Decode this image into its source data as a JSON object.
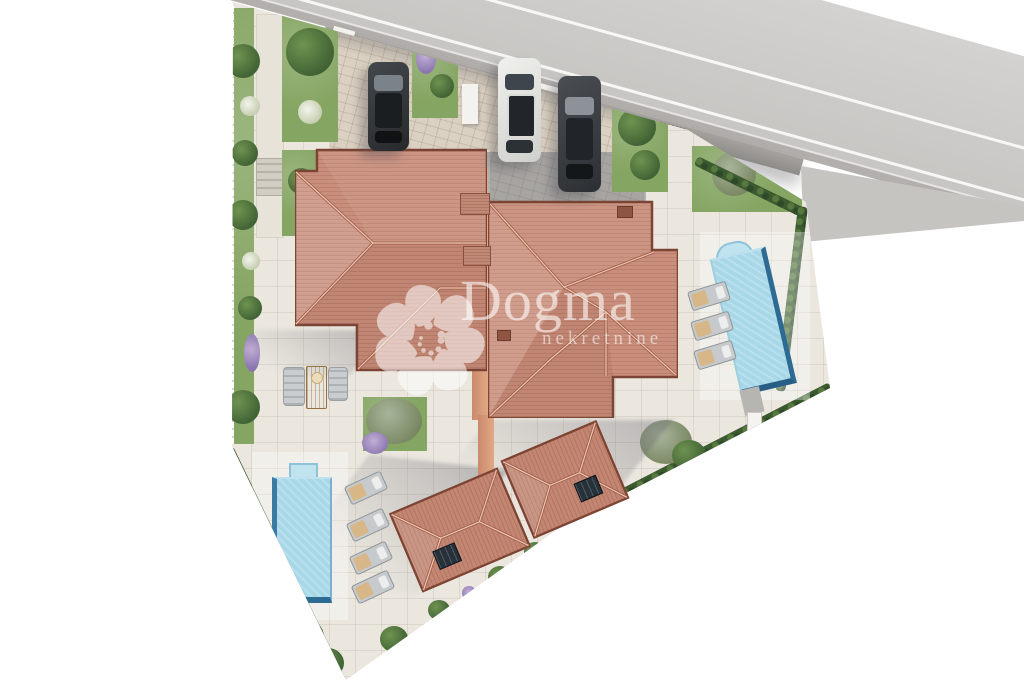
{
  "watermark": {
    "brand": "Dogma",
    "subtitle": "nekretnine"
  },
  "scene": {
    "description": "Aerial 3D site-plan render of two semi-detached villas with private pools, gardens and parking, bordered by a road at the top",
    "road": {
      "surface_color": "#c9c7c4",
      "lane_line_color": "#f4f3f1",
      "lane_lines_visible": 2
    },
    "parcel": {
      "paving_color": "#ebe7df",
      "boundary": "hedges and white fence"
    },
    "buildings": [
      {
        "id": "villa-left",
        "roof_color": "#c98f7c"
      },
      {
        "id": "villa-right",
        "roof_color": "#c98f7c"
      },
      {
        "id": "annex-left",
        "roof_color": "#c28672",
        "solar_panel": true
      },
      {
        "id": "annex-right",
        "roof_color": "#c28672",
        "solar_panel": true
      }
    ],
    "pools": [
      {
        "id": "pool-left",
        "water_color": "#a8d8e8",
        "loungers": 4
      },
      {
        "id": "pool-right",
        "water_color": "#a8d8e8",
        "loungers": 3,
        "steps": "roman"
      }
    ],
    "cars": [
      {
        "id": "car-left",
        "color": "dark-gray"
      },
      {
        "id": "car-middle",
        "color": "white"
      },
      {
        "id": "car-right",
        "color": "dark-gray"
      }
    ],
    "furniture": {
      "terrace_chairs": 2,
      "terrace_table": 1
    }
  }
}
